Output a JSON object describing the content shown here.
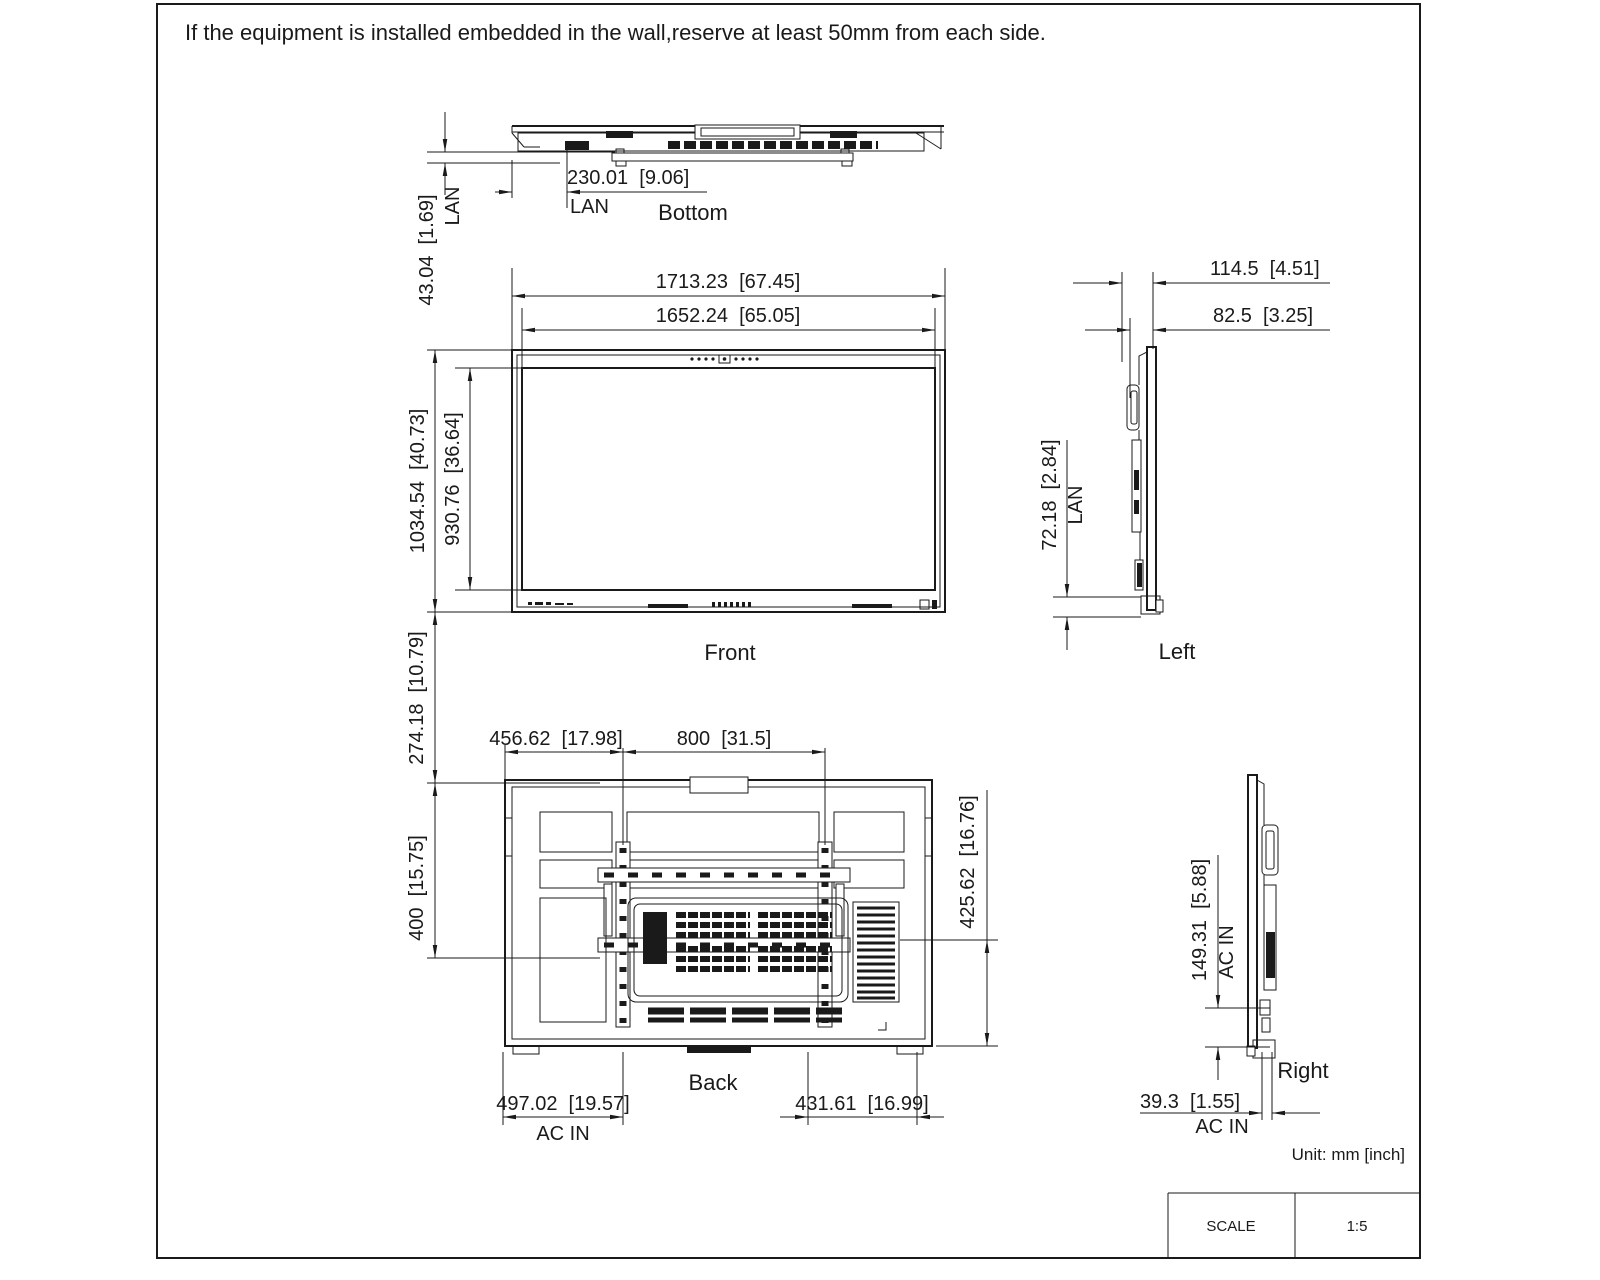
{
  "ink_color": "#1a1a1a",
  "note": "If the equipment is installed embedded in the wall,reserve at least 50mm from each side.",
  "unit_note": "Unit: mm [inch]",
  "scale_table": {
    "label": "SCALE",
    "value": "1:5"
  },
  "views": {
    "bottom": {
      "label": "Bottom",
      "dim_lan_offset": "230.01  [9.06]",
      "lan_label": "LAN",
      "dim_lan_depth": "43.04  [1.69]",
      "lan_side_label": "LAN"
    },
    "front": {
      "label": "Front",
      "dim_overall_width": "1713.23  [67.45]",
      "dim_screen_width": "1652.24  [65.05]",
      "dim_overall_height": "1034.54  [40.73]",
      "dim_screen_height": "930.76  [36.64]"
    },
    "left": {
      "label": "Left",
      "dim_depth_total": "114.5  [4.51]",
      "dim_depth_body": "82.5  [3.25]",
      "dim_lan_height": "72.18  [2.84]",
      "lan_label": "LAN"
    },
    "back": {
      "label": "Back",
      "dim_vesa_offset_x": "456.62  [17.98]",
      "dim_vesa_width": "800  [31.5]",
      "dim_top_offset": "274.18  [10.79]",
      "dim_vesa_height": "400  [15.75]",
      "dim_bottom_offset": "425.62  [16.76]",
      "dim_ac_offset_x": "497.02  [19.57]",
      "ac_label": "AC IN",
      "dim_right_offset": "431.61  [16.99]"
    },
    "right": {
      "label": "Right",
      "dim_ac_height": "149.31  [5.88]",
      "ac_side_label": "AC IN",
      "dim_ac_depth": "39.3  [1.55]",
      "ac_bottom_label": "AC IN"
    }
  }
}
